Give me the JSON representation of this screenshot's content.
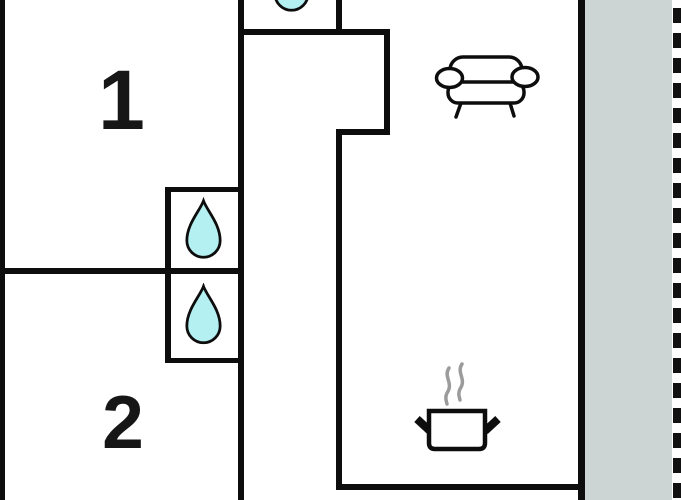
{
  "plan": {
    "rooms": [
      {
        "id": "room-1",
        "label": "1"
      },
      {
        "id": "room-2",
        "label": "2"
      }
    ],
    "icons": [
      {
        "name": "water-drop-icon",
        "area": "utility-top"
      },
      {
        "name": "water-drop-icon",
        "area": "bathroom-upper"
      },
      {
        "name": "water-drop-icon",
        "area": "bathroom-lower"
      },
      {
        "name": "sofa-icon",
        "area": "living-room"
      },
      {
        "name": "cooking-pot-icon",
        "area": "kitchen"
      },
      {
        "name": "steam-icon",
        "area": "kitchen"
      }
    ],
    "colors": {
      "wall": "#0d0d0d",
      "water_drop": "#b4f0f2",
      "terrace": "#ccd5d3",
      "steam": "#9b9b9b",
      "outline": "#0d0d0d",
      "background": "#ffffff"
    }
  }
}
